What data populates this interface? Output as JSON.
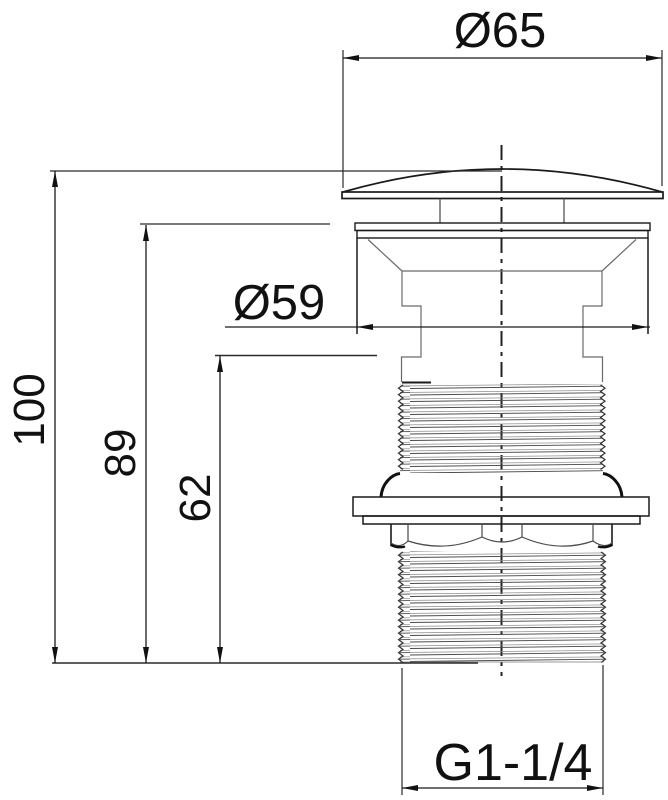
{
  "labels": {
    "cap_diameter": "Ø65",
    "body_diameter": "Ø59",
    "overall_height": "100",
    "height_to_flange": "89",
    "height_to_shoulder": "62",
    "thread_size": "G1-1/4"
  },
  "colors": {
    "line": "#1a1a1a",
    "thin_line": "#2a2a2a",
    "thread_line": "#555555",
    "background": "#ffffff"
  }
}
